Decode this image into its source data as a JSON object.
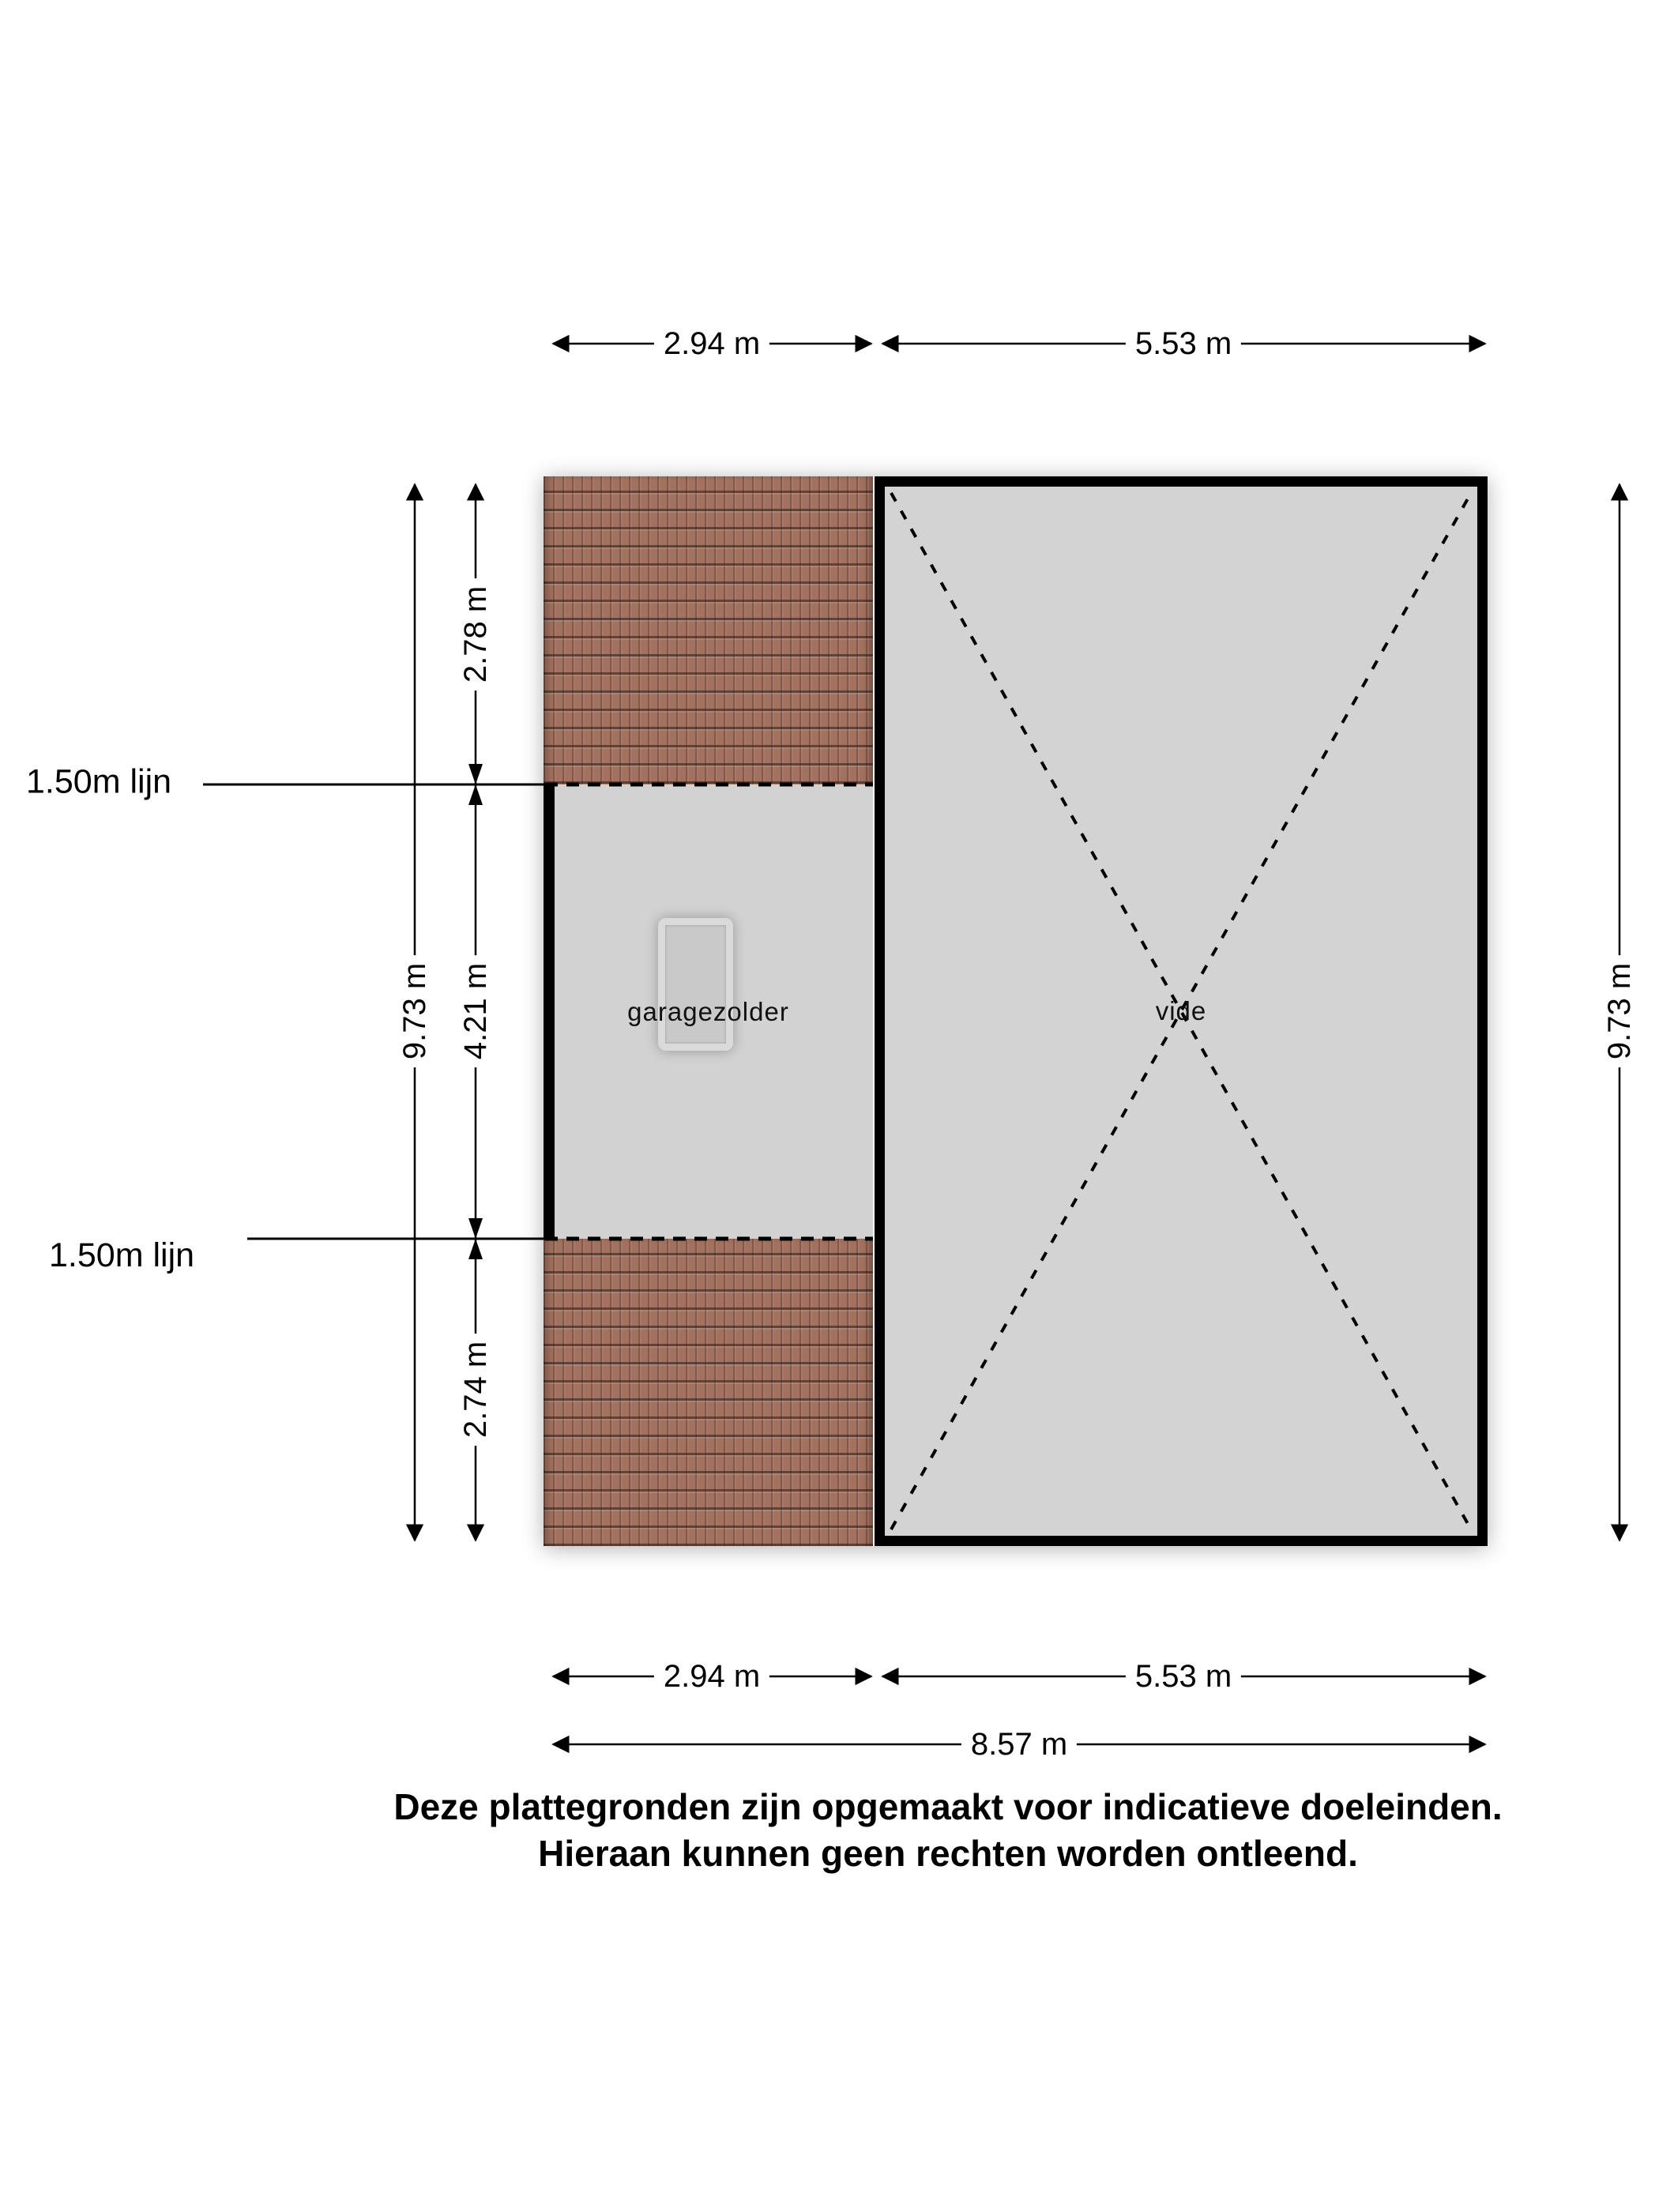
{
  "floorplan": {
    "rooms": [
      {
        "label": "garagezolder"
      },
      {
        "label": "vide"
      }
    ]
  },
  "dimensions": {
    "top": [
      {
        "label": "2.94 m"
      },
      {
        "label": "5.53 m"
      }
    ],
    "left_segments": [
      {
        "label": "2.78 m"
      },
      {
        "label": "4.21 m"
      },
      {
        "label": "2.74 m"
      }
    ],
    "left_total": {
      "label": "9.73 m"
    },
    "right_total": {
      "label": "9.73 m"
    },
    "bottom": [
      {
        "label": "2.94 m"
      },
      {
        "label": "5.53 m"
      }
    ],
    "bottom_total": {
      "label": "8.57 m"
    },
    "height_lines": [
      {
        "label": "1.50m lijn"
      },
      {
        "label": "1.50m lijn"
      }
    ]
  },
  "disclaimer": {
    "line1": "Deze plattegronden zijn opgemaakt voor indicatieve doeleinden.",
    "line2": "Hieraan kunnen geen rechten worden ontleend."
  },
  "colors": {
    "background": "#ffffff",
    "roof": "#a3715f",
    "room_fill": "#d2d2d2",
    "vide_fill": "#d3d3d3",
    "wall": "#000000",
    "line": "#000000"
  }
}
